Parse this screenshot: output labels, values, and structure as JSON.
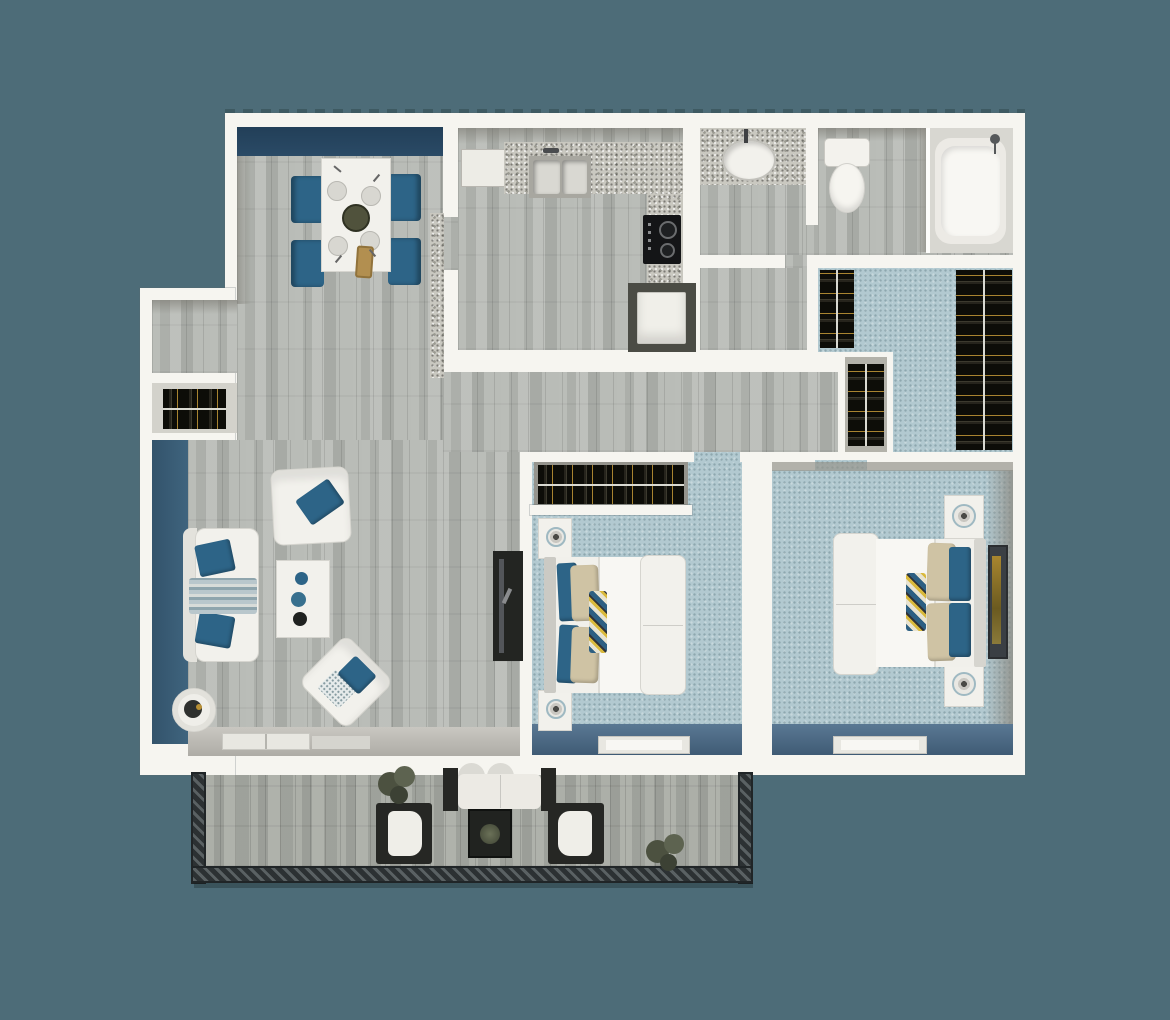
{
  "scene": {
    "description": "3D top-down rendering of a two-bedroom apartment floor plan with patio",
    "view": "top-down-3d",
    "background": "#4d6c78"
  },
  "palette": {
    "bg": "#4d6c78",
    "wall": "#f6f5f0",
    "navy": "#2a4a66",
    "living-blue": "#3f647e",
    "wood": "#b5b8b3",
    "deck": "#a7aaa3",
    "carpet": "#b2c9d0",
    "floor-shadow": "#3f5b75",
    "granite": "#c9c8c0",
    "accent-blue": "#2d6487",
    "tan": "#cfc3a4",
    "white-furn": "#f2f1ec",
    "dark-furn": "#262724",
    "rail-dark": "#2c3133",
    "rail-light": "#5a6163",
    "hanger-gold": "#b99034",
    "plant-green": "#545947"
  },
  "rooms": {
    "dining": {
      "label": "Dining area with table, four blue chairs and navy accent wall"
    },
    "kitchen": {
      "label": "Kitchen with L-shaped granite counter, sink, fridge and stove"
    },
    "laundry": {
      "label": "Laundry closet with washer"
    },
    "vanity": {
      "label": "Bathroom vanity with sink"
    },
    "bathroom": {
      "label": "Bathroom with toilet and bathtub"
    },
    "walkin": {
      "label": "Walk-in closet with hanging clothes"
    },
    "linen": {
      "label": "Small closet with hanging clothes"
    },
    "coat": {
      "label": "Coat closet with hanging clothes"
    },
    "entry": {
      "label": "Entry alcove"
    },
    "hallway": {
      "label": "Hallway"
    },
    "living": {
      "label": "Living room with sofa, armchairs, coffee table and TV stand"
    },
    "bedroom1": {
      "label": "Bedroom with closet, bed and nightstands"
    },
    "master": {
      "label": "Master bedroom with bed, nightstands and wall art"
    },
    "patio": {
      "label": "Patio with railing, lounge chairs, loveseat and plants"
    }
  }
}
